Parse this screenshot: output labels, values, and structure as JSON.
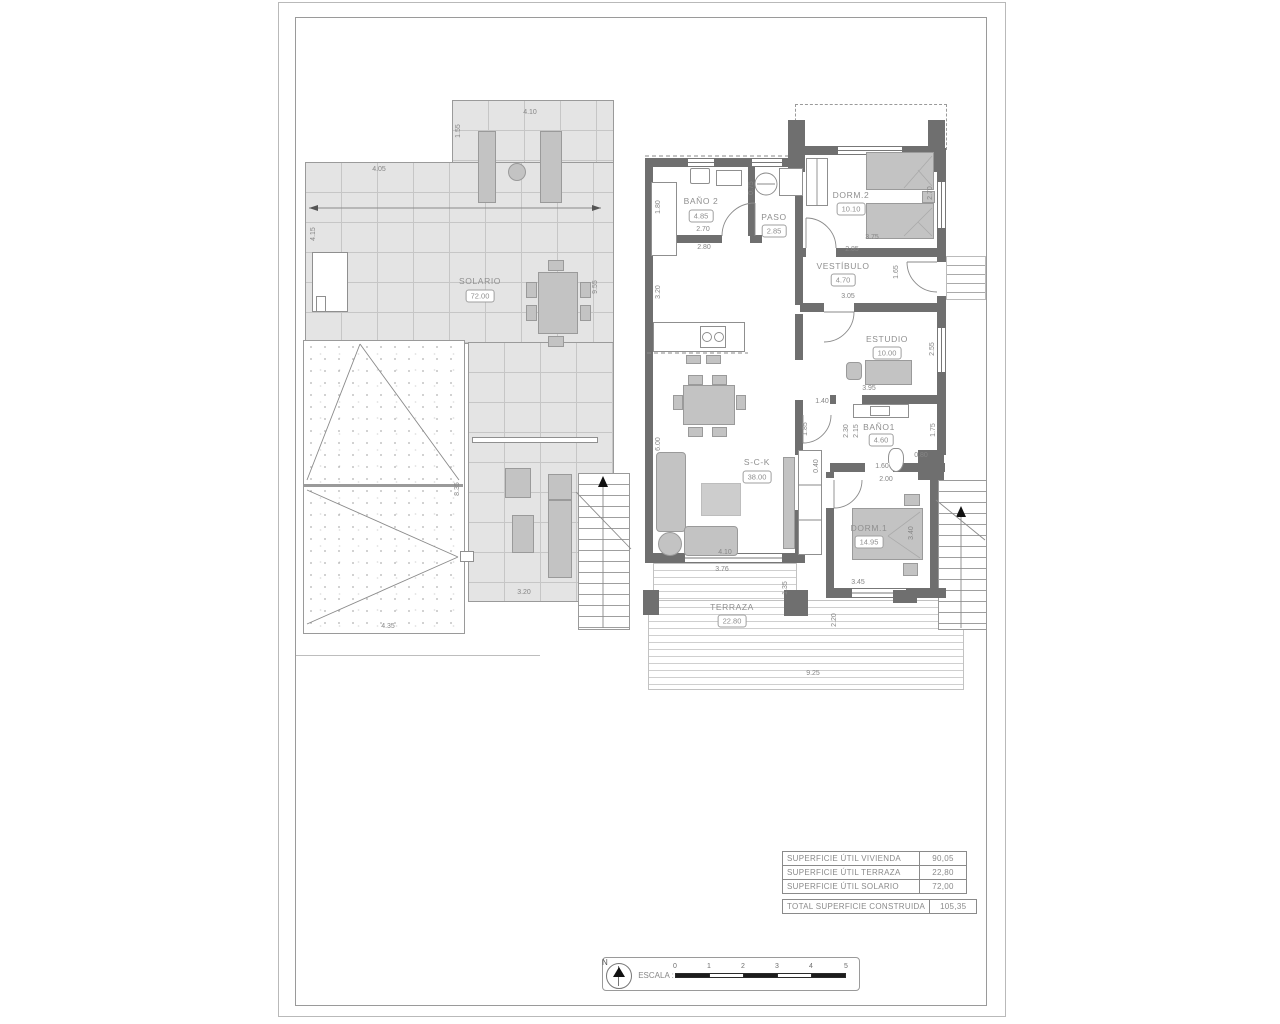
{
  "colors": {
    "wall": "#6f6f6f",
    "tile": "#e4e4e4",
    "furniture": "#c3c3c3",
    "text": "#8a8a8a"
  },
  "solario_plan": {
    "room": {
      "name": "SOLARIO",
      "area": "72.00"
    },
    "dims": {
      "top_width": "4.10",
      "top_height": "1.55",
      "mid_width": "4.05",
      "left_height": "4.15",
      "right_height": "9.55",
      "roof_height": "8.35",
      "roof_width": "4.35",
      "terrace_width": "3.20"
    }
  },
  "vivienda_plan": {
    "rooms": {
      "bano2": {
        "name": "BAÑO 2",
        "area": "4.85"
      },
      "paso": {
        "name": "PASO",
        "area": "2.85"
      },
      "dorm2": {
        "name": "DORM.2",
        "area": "10.10"
      },
      "vestibulo": {
        "name": "VESTÍBULO",
        "area": "4.70"
      },
      "estudio": {
        "name": "ESTUDIO",
        "area": "10.00"
      },
      "bano1": {
        "name": "BAÑO1",
        "area": "4.60"
      },
      "sck": {
        "name": "S-C-K",
        "area": "38.00"
      },
      "dorm1": {
        "name": "DORM.1",
        "area": "14.95"
      },
      "terraza": {
        "name": "TERRAZA",
        "area": "22.80"
      }
    },
    "dims": {
      "bano2_height": "1.80",
      "bano2_width": "2.70",
      "bano2_width_ext": "2.80",
      "paso_height": "0.75",
      "dorm2_height": "2.70",
      "dorm2_width": "3.75",
      "vestibulo_width": "2.85",
      "vestibulo_height": "1.65",
      "vestibulo_width2": "3.05",
      "estudio_height": "2.55",
      "estudio_width": "3.95",
      "hall_width": "1.40",
      "hall_opening": "1.85",
      "kitchen_height": "3.20",
      "sck_height": "6.00",
      "nook_width": "0.40",
      "bano1_height1": "2.30",
      "bano1_height2": "2.15",
      "bano1_right": "1.75",
      "bano1_right2": "0.80",
      "bano1_width": "1.60",
      "bano1_width2": "2.00",
      "sck_width": "4.10",
      "terraza_width": "3.76",
      "terraza_height": "1.35",
      "dorm1_width": "3.45",
      "dorm1_height": "3.40",
      "terraza_height2": "2.20",
      "total_width": "9.25"
    }
  },
  "surface_table": {
    "rows": [
      {
        "label": "SUPERFICIE ÚTIL VIVIENDA",
        "value": "90,05"
      },
      {
        "label": "SUPERFICIE ÚTIL TERRAZA",
        "value": "22,80"
      },
      {
        "label": "SUPERFICIE ÚTIL SOLARIO",
        "value": "72,00"
      }
    ],
    "total": {
      "label": "TOTAL SUPERFICIE CONSTRUIDA",
      "value": "105,35"
    }
  },
  "scale_bar": {
    "north_label": "N",
    "label": "ESCALA :",
    "ticks": [
      "0",
      "1",
      "2",
      "3",
      "4",
      "5"
    ]
  }
}
